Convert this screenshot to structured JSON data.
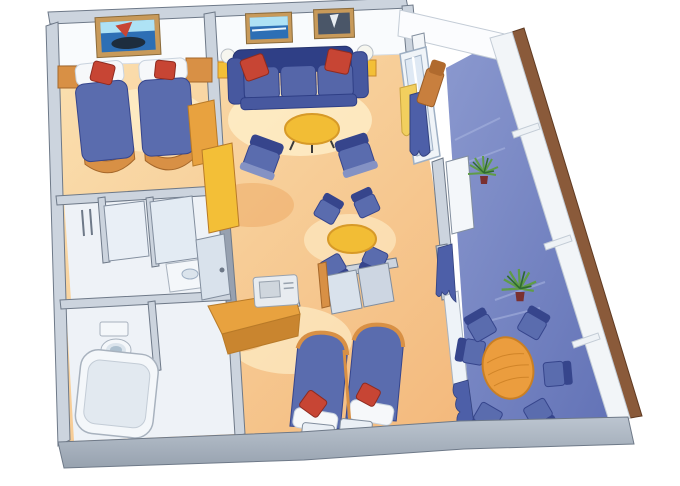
{
  "scene": {
    "type": "3d-cutaway-floor-plan",
    "subject": "two-bedroom suite stateroom with private balcony",
    "rooms": [
      {
        "name": "second-bedroom",
        "furniture": [
          "twin-bed",
          "twin-bed",
          "red-accent-pillows",
          "nightstands",
          "wall-art-ship",
          "wardrobe"
        ]
      },
      {
        "name": "living-room",
        "furniture": [
          "sofa",
          "red-accent-pillows",
          "coffee-table",
          "armchair",
          "armchair",
          "table-lamps",
          "dining-table",
          "dining-chairs",
          "wall-art-ocean",
          "wall-art-sailboat",
          "balcony-door",
          "curtains",
          "closet"
        ]
      },
      {
        "name": "master-bedroom",
        "furniture": [
          "twin-bed",
          "twin-bed",
          "desk",
          "tv",
          "benches",
          "window-curtains"
        ]
      },
      {
        "name": "bathroom-upper",
        "furniture": [
          "shower-glass",
          "door",
          "vanity-sink",
          "towel-bars"
        ]
      },
      {
        "name": "bathroom-lower",
        "furniture": [
          "bathtub",
          "toilet"
        ]
      },
      {
        "name": "balcony",
        "furniture": [
          "round-table",
          "balcony-chairs",
          "lounge-chair",
          "potted-plant",
          "potted-plant",
          "railing-shelves",
          "privacy-divider"
        ]
      }
    ]
  },
  "colors": {
    "bg": "#ffffff",
    "wallTop": "#ccd4de",
    "wallFace": "#97a1b0",
    "wallStroke": "#6e7988",
    "backWall": "#f9fbfd",
    "bandLight": "#bcc5d0",
    "bandDark": "#97a2af",
    "floorWarm1": "#fbe2b3",
    "floorWarm2": "#f3b87b",
    "floorGlow": "#fff3d0",
    "floorDeep": "#eca55e",
    "bathFloor": "#eef2f7",
    "balcony1": "#8b99cf",
    "balcony2": "#6272b6",
    "balconyStreak": "#a9b6e0",
    "sofaBlue": "#5566a9",
    "sofaMid": "#47589f",
    "sofaDark": "#2f3f86",
    "chairBlue": "#5a6cae",
    "chairDark": "#36458c",
    "chairLight": "#8492c4",
    "redPillow": "#c74534",
    "redPillowDark": "#8f2b20",
    "whiteSoft": "#f6f8fa",
    "pillowStroke": "#c9d3de",
    "woodLight": "#f3bf37",
    "woodLightEdge": "#c9882a",
    "tableYellow": "#f2bd35",
    "tableYellowEdge": "#d79a28",
    "woodMid": "#e8a23f",
    "woodMidEdge": "#b87a28",
    "woodDark": "#c9852f",
    "woodTrim": "#d89045",
    "woodTrimEdge": "#a5672a",
    "balconyTable": "#eb9d3e",
    "balconyTableEdge": "#c97f24",
    "glass": "#dfe9f4",
    "glassFrame": "#9fb0c4",
    "frameWhite": "#f0f4f8",
    "curtainYellow": "#f2cf5e",
    "curtainYellowEdge": "#caa53e",
    "curtainBlue": "#4d5fa8",
    "curtainBlueEdge": "#33427f",
    "artFrame": "#c89a5a",
    "artFrameEdge": "#8a6a3a",
    "artSea": "#2d6fb5",
    "artSky": "#aee2f5",
    "artDark": "#4a5668",
    "artHull": "#1d2d3e",
    "plantGreen1": "#2f6b2f",
    "plantGreen2": "#5f9c47",
    "plantPot": "#7a3030",
    "fixtureWhite": "#f4f7fa",
    "fixtureStroke": "#a8b2be",
    "tubInner": "#e2e9f0",
    "sinkInner": "#dbe4ec",
    "water": "#adc0cf",
    "tvBody": "#e8ecf0",
    "tvScreen": "#cfd6dd",
    "tvStroke": "#98a2ae",
    "lampWhite": "#f6f6ef",
    "lampStroke": "#b9bfc6",
    "brownEdge": "#8a5a3a",
    "brownEdgeDark": "#5f3a22",
    "outerWallWhite": "#f2f5f8",
    "panelGray": "#d9e2ec",
    "panelGray2": "#cdd6e2",
    "panelStroke": "#828e9e",
    "loungeWood": "#c87f3e",
    "loungeWoodDark": "#b06a2e",
    "legDark": "#3a3a3a",
    "shelfWhite": "#eef2f6",
    "shelfStroke": "#c3ccd6"
  }
}
